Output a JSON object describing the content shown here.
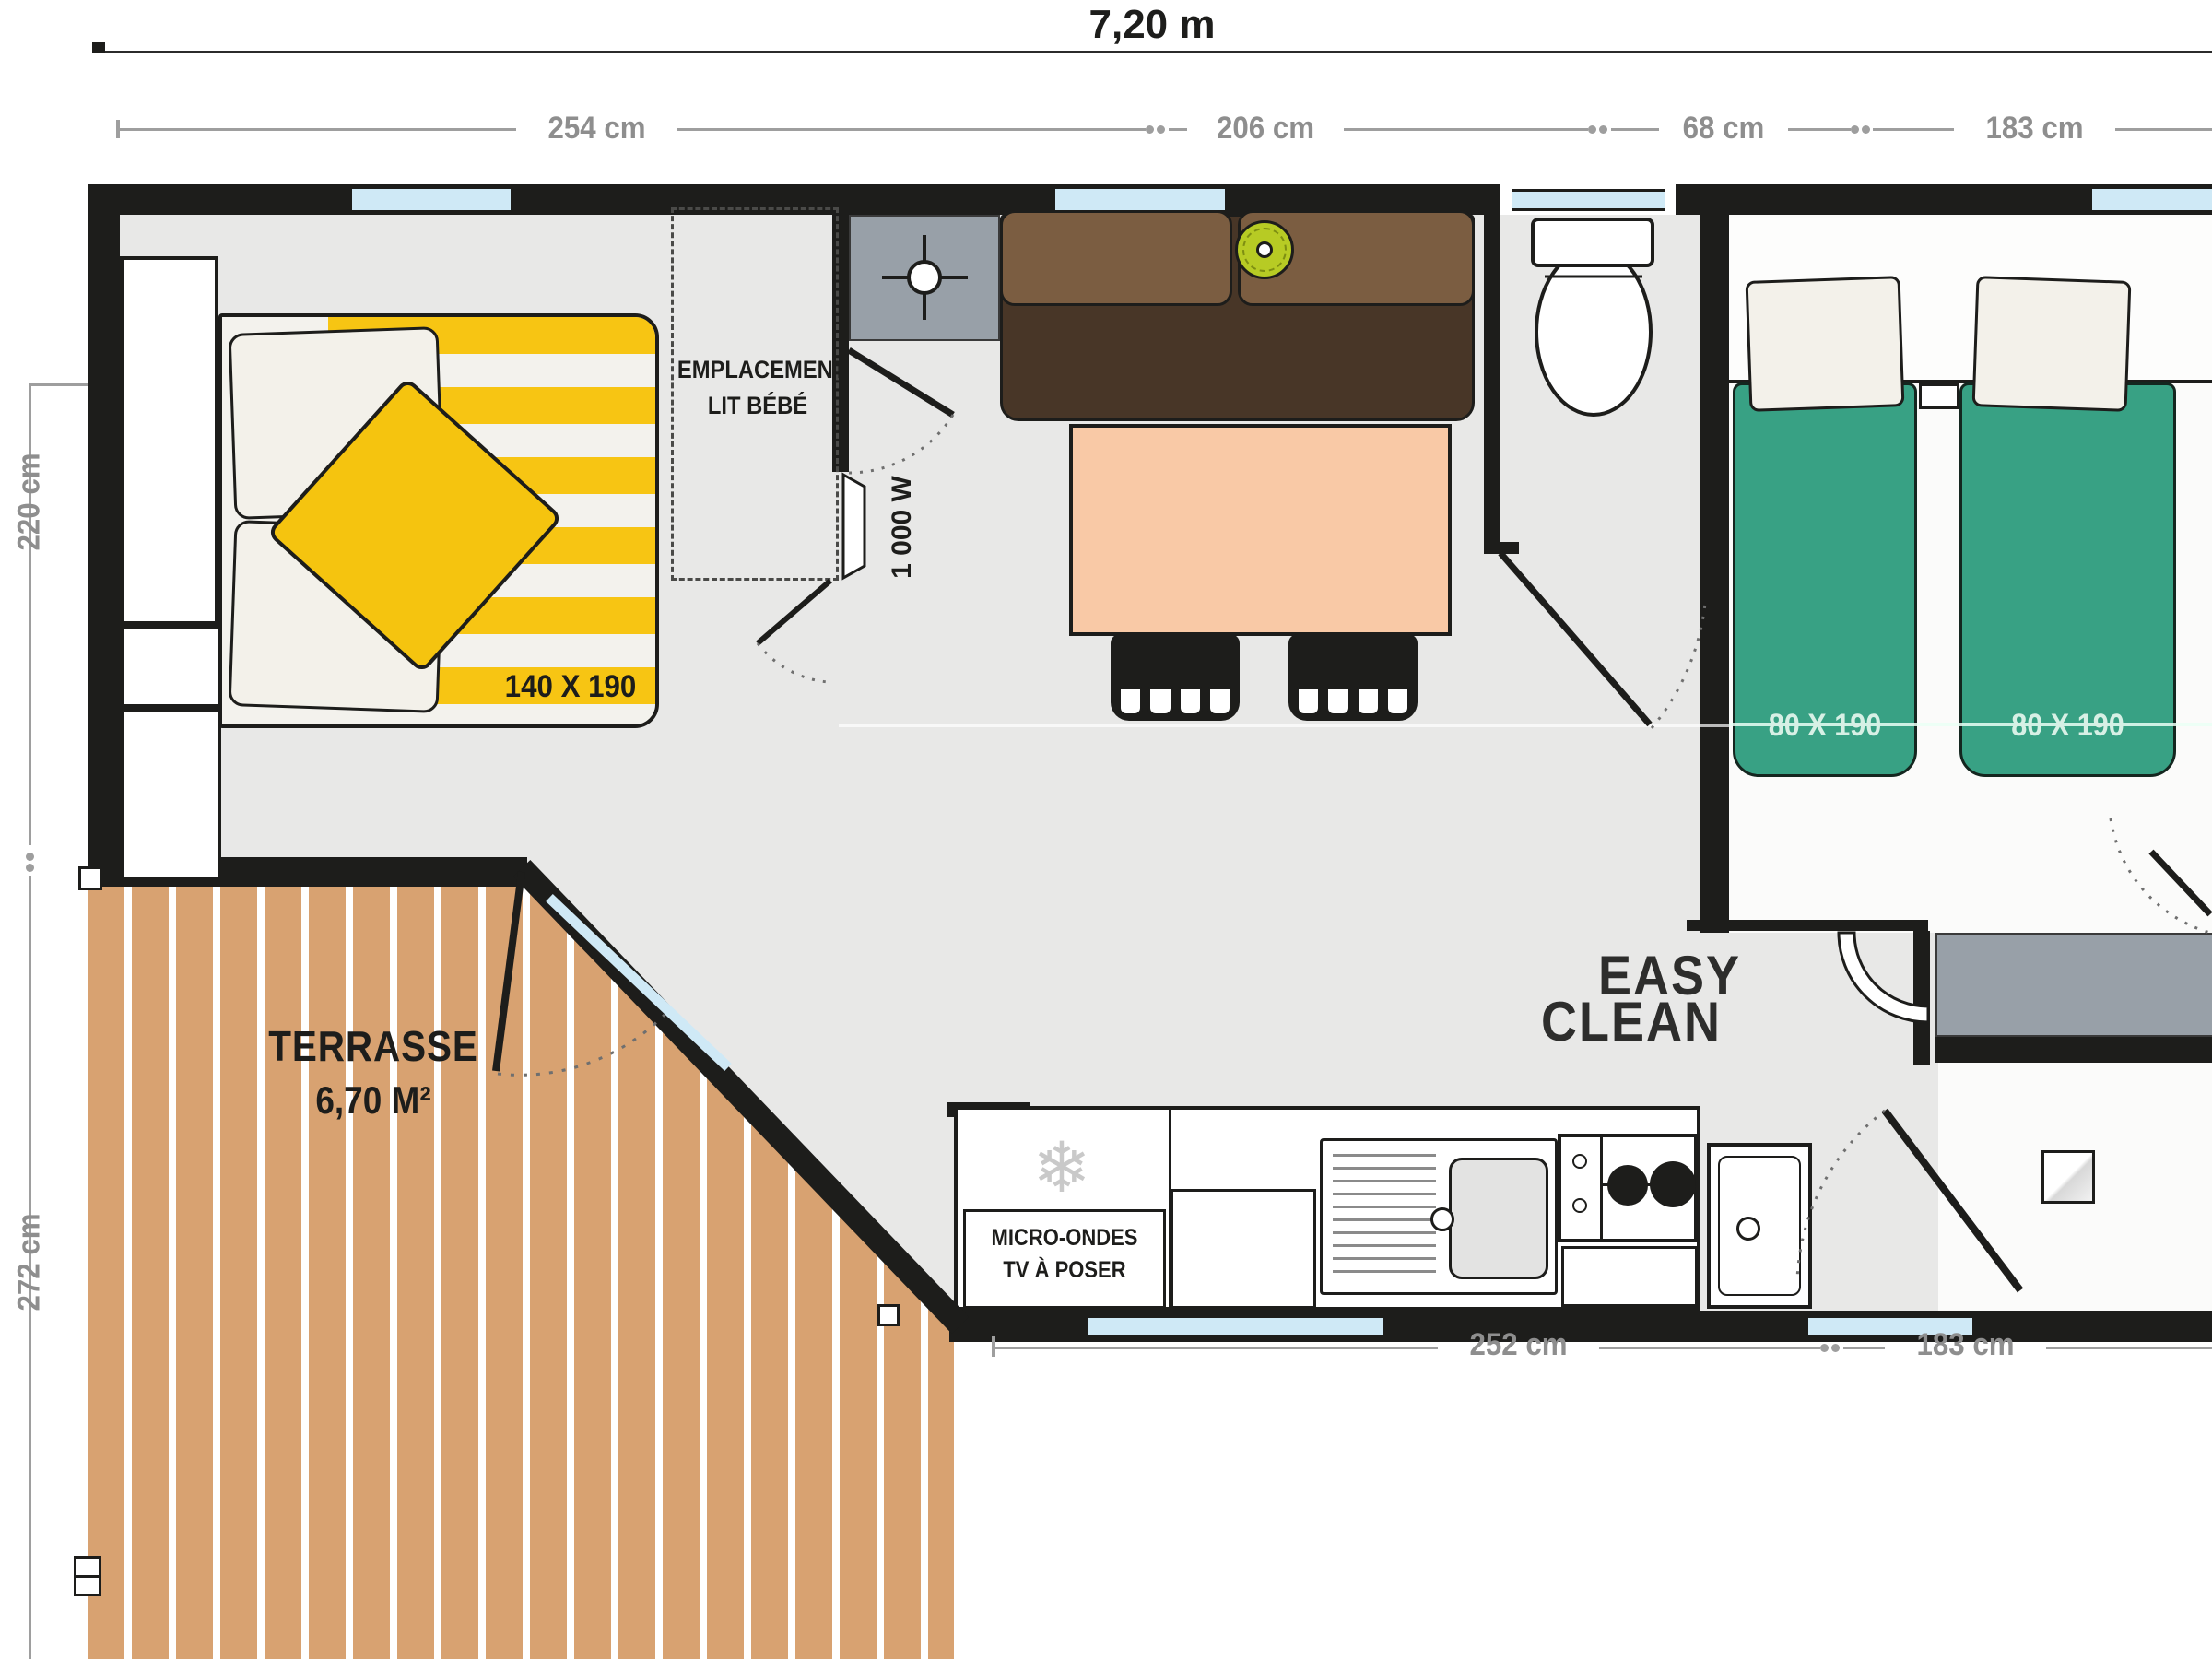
{
  "dims": {
    "total_width": "7,20 m",
    "top": [
      "254 cm",
      "206 cm",
      "68 cm",
      "183 cm"
    ],
    "left": [
      "220 cm",
      "272 cm"
    ],
    "bottom": [
      "252 cm",
      "183 cm"
    ]
  },
  "master_bedroom": {
    "bed_size": "140 X 190",
    "crib_zone_line1": "EMPLACEMENT",
    "crib_zone_line2": "LIT BÉBÉ"
  },
  "living": {
    "heater_power": "1 000 W"
  },
  "kids_bedroom": {
    "bed1_size": "80 X 190",
    "bed2_size": "80 X 190"
  },
  "bathroom": {
    "brand_line1": "EASY",
    "brand_line2": "CLEAN"
  },
  "kitchen": {
    "note_line1": "MICRO-ONDES",
    "note_line2": "TV À POSER",
    "snowflake_icon": "❄"
  },
  "terrace": {
    "name": "TERRASSE",
    "area": "6,70 M²"
  },
  "colors": {
    "wall": "#1d1d1b",
    "floor": "#e8e8e7",
    "bed_yellow": "#f7c513",
    "bed_green": "#38a184",
    "wood": "#d8a271",
    "window_glass": "#cfe9f6",
    "sofa_seat": "#483627",
    "sofa_back": "#7b5d41",
    "table_salmon": "#f9c9a6",
    "lamp_lime": "#b7cb24",
    "unit_gray": "#98a0a8",
    "dim_gray": "#8e8e8e"
  }
}
